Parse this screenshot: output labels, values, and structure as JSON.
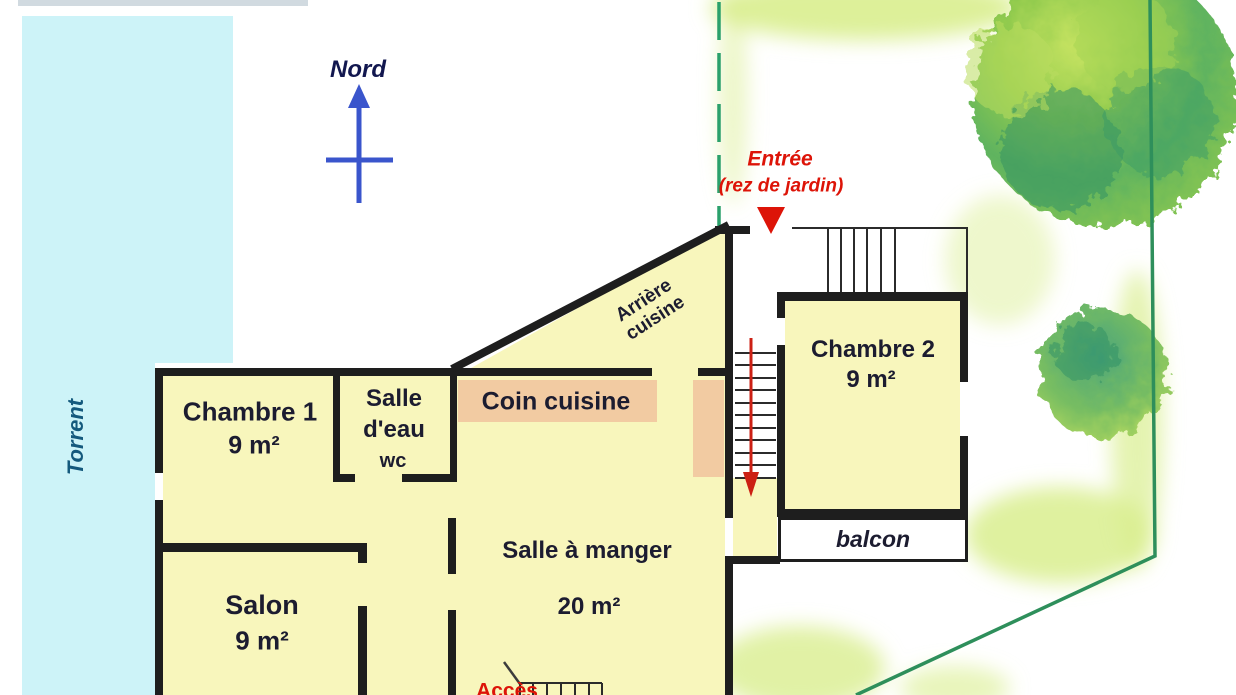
{
  "plan": {
    "compass_label": "Nord",
    "water_label": "Torrent",
    "entrance": {
      "title": "Entrée",
      "subtitle": "(rez de jardin)"
    },
    "access_label": "Accès",
    "rooms": {
      "back_kitchen": {
        "line1": "Arrière",
        "line2": "cuisine"
      },
      "bedroom1": {
        "name": "Chambre 1",
        "area": "9 m²"
      },
      "shower_room": {
        "line1": "Salle",
        "line2": "d'eau",
        "line3": "wc"
      },
      "kitchen_corner": {
        "name": "Coin cuisine"
      },
      "dining_room": {
        "name": "Salle à manger",
        "area": "20 m²"
      },
      "living_room": {
        "name": "Salon",
        "area": "9 m²"
      },
      "bedroom2": {
        "name": "Chambre 2",
        "area": "9 m²"
      },
      "balcony": {
        "name": "balcon"
      }
    }
  },
  "colors": {
    "wall": "#1e1e1e",
    "room": "#f8f6bc",
    "peach": "#f2cba2",
    "water": "#cdf3f8",
    "water_text": "#14597d",
    "label": "#1c1c30",
    "north_text": "#12174f",
    "north_blue": "#3a55cc",
    "red": "#dd1408",
    "arrow_red": "#cc2014",
    "green_line": "#2aa06b",
    "boundary": "#2e8f5b",
    "wash": "#d9ee8e",
    "stair_line": "#2b2b2b",
    "tree_light": "#b9dc5e",
    "tree_mid": "#7cc24f",
    "tree_dark": "#2f8f63"
  }
}
